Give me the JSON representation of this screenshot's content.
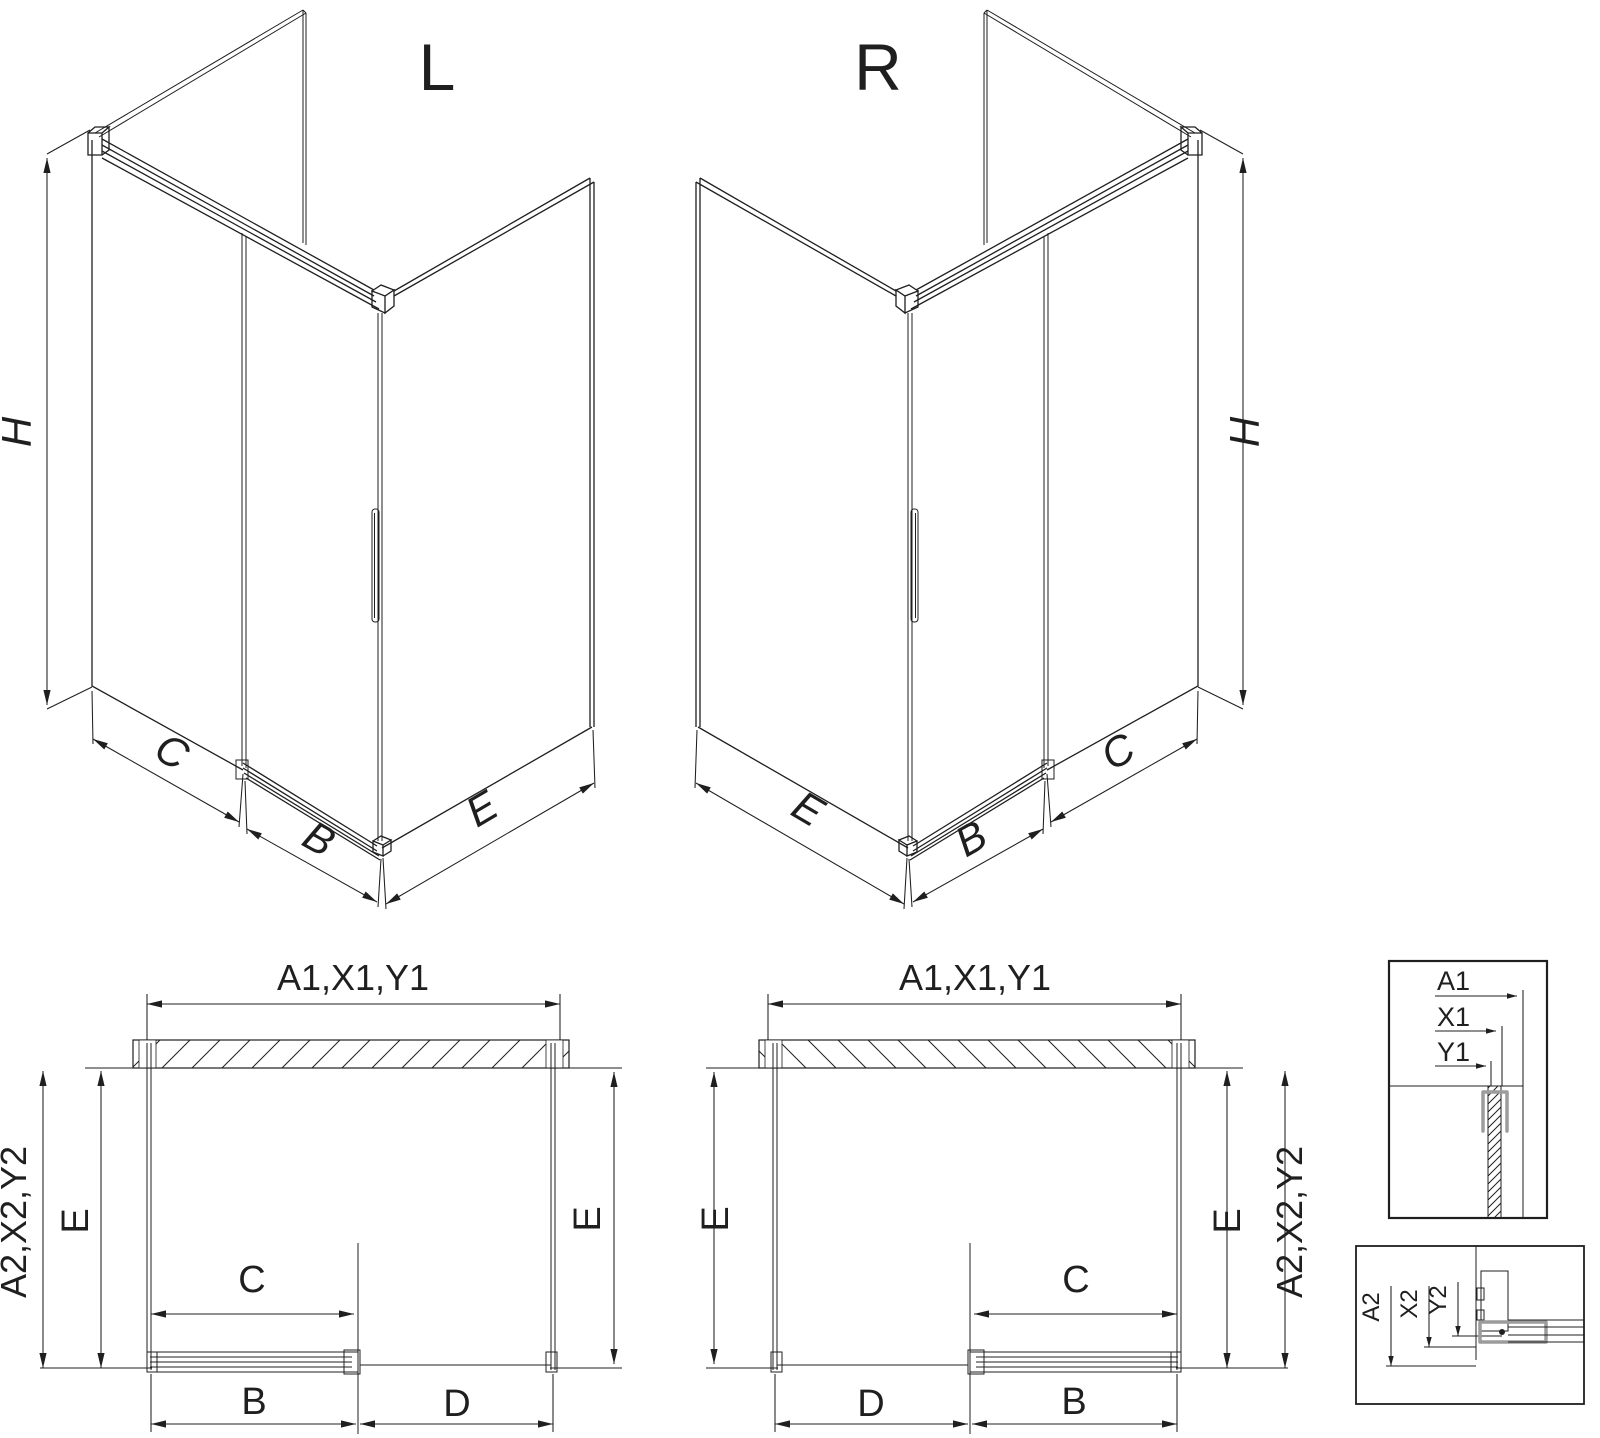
{
  "views": {
    "iso_left_label": "L",
    "iso_right_label": "R"
  },
  "dimension_labels": {
    "height": "H",
    "fixed_panel_width": "C",
    "door_width": "B",
    "side_panel_width": "E",
    "entry_width": "D",
    "total_width": "A1,X1,Y1",
    "total_depth": "A2,X2,Y2"
  },
  "detail_callouts": {
    "top": {
      "a1": "A1",
      "x1": "X1",
      "y1": "Y1"
    },
    "bottom": {
      "a2": "A2",
      "x2": "X2",
      "y2": "Y2"
    }
  },
  "colors": {
    "line": "#1f1f1f",
    "profile_gray": "#9c9c9c",
    "background": "#ffffff"
  }
}
